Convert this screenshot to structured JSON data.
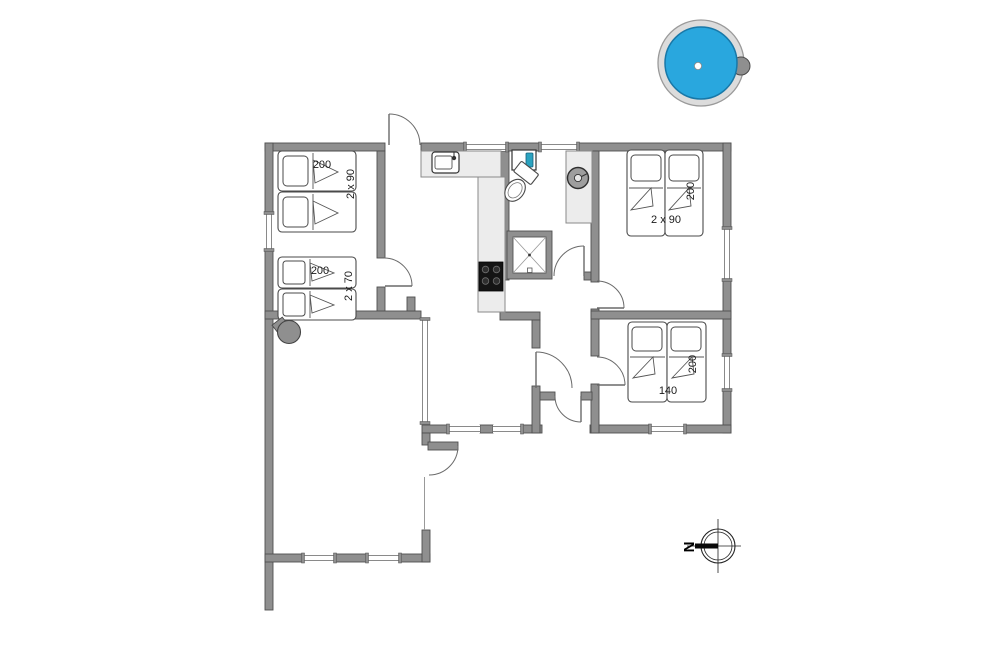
{
  "rooms": {
    "bedroom_top_left": {
      "bed_length": "200",
      "bed_width": "2 x 90"
    },
    "bedroom_bottom_left": {
      "bed_length": "200",
      "bed_width": "2 x 70"
    },
    "bedroom_top_right": {
      "bed_length": "200",
      "bed_width": "2 x 90"
    },
    "bedroom_bottom_right": {
      "bed_length": "200",
      "bed_width": "140"
    }
  },
  "compass": {
    "north_label": "N"
  },
  "colors": {
    "wall": "#8f8f8f",
    "hot_tub_water": "#29a7de",
    "hot_tub_water_edge": "#1878a8",
    "counter": "#ececec",
    "faucet_teal": "#2ba3c0",
    "stove": "#141414"
  },
  "icons": {
    "hot_tub": "blue circle with gray ring and knob",
    "grill": "gray circle with handle",
    "washing_machine": "circle in circle with tick",
    "shower": "square with X",
    "toilet": "tank and bowl ellipse",
    "hand_sink": "box with teal faucet",
    "kitchen_sink": "rounded box with tap",
    "stove": "black square with 4 burners",
    "compass": "crosshair circle with north bar"
  }
}
